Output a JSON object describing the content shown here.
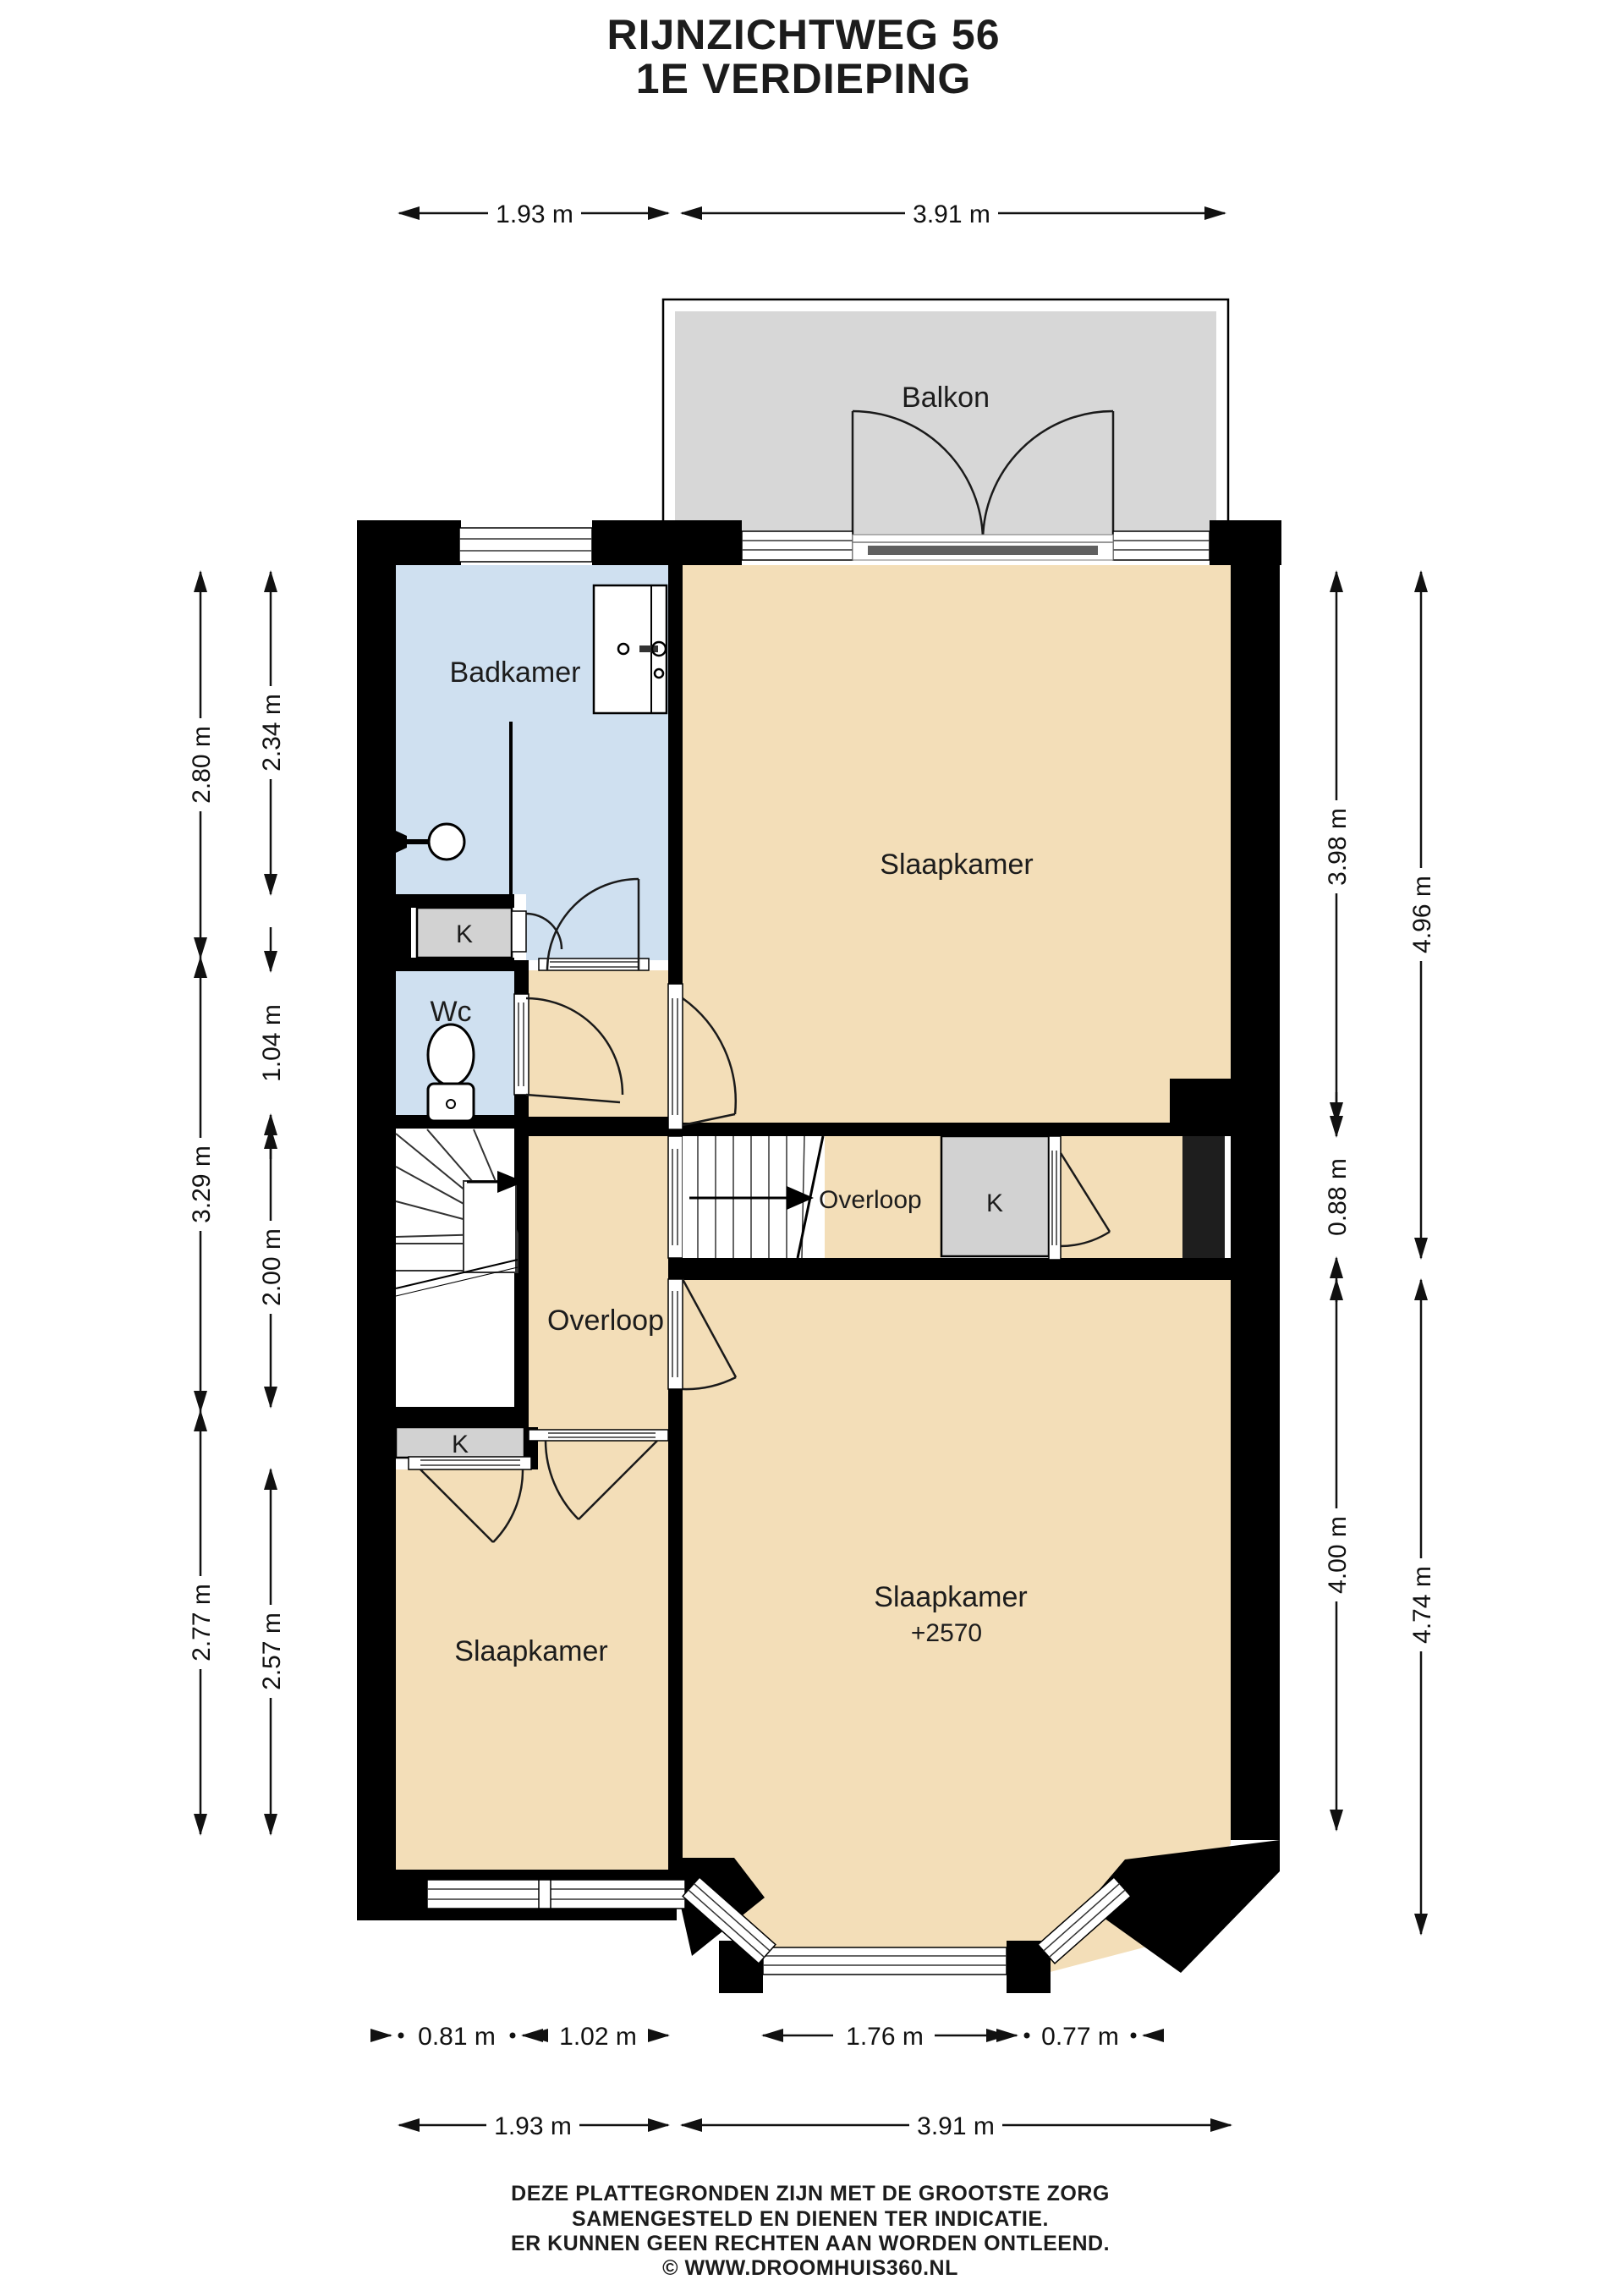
{
  "title": {
    "line1": "RIJNZICHTWEG 56",
    "line2": "1E VERDIEPING"
  },
  "rooms": {
    "balkon": "Balkon",
    "badkamer": "Badkamer",
    "slaapkamer_top": "Slaapkamer",
    "wc": "Wc",
    "closet": "K",
    "overloop": "Overloop",
    "overloop_small": "Overloop",
    "slaapkamer_left": "Slaapkamer",
    "slaapkamer_right": "Slaapkamer",
    "slaapkamer_right_level": "+2570"
  },
  "dims": {
    "top": [
      "1.93 m",
      "3.91 m"
    ],
    "bottom_windows": [
      "0.81 m",
      "1.02 m",
      "1.76 m",
      "0.77 m"
    ],
    "bottom_total": [
      "1.93 m",
      "3.91 m"
    ],
    "left_outer": [
      "2.80 m",
      "3.29 m",
      "2.77 m"
    ],
    "left_inner": [
      "2.34 m",
      "1.04 m",
      "2.00 m",
      "2.57 m"
    ],
    "right_inner": [
      "3.98 m",
      "0.88 m",
      "4.00 m"
    ],
    "right_outer": [
      "4.96 m",
      "4.74 m"
    ]
  },
  "footer": {
    "line1": "DEZE PLATTEGRONDEN ZIJN MET DE GROOTSTE ZORG",
    "line2": "SAMENGESTELD EN DIENEN TER INDICATIE.",
    "line3": "ER KUNNEN GEEN RECHTEN AAN WORDEN ONTLEEND.",
    "line4": "© WWW.DROOMHUIS360.NL"
  },
  "colors": {
    "wall": "#000000",
    "room_beige": "#f3deb8",
    "room_blue": "#cfe0f0",
    "closet_gray": "#d2d2d2",
    "balcony_gray": "#d7d7d7",
    "shaft_dark": "#1e1e1e"
  }
}
